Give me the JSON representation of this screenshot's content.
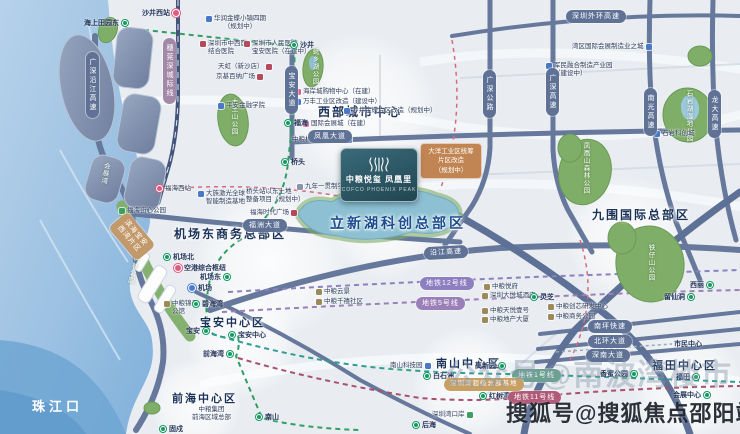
{
  "colors": {
    "sea": "#9cc1e2",
    "land": "#eaedf0",
    "road": "#66789b",
    "park": "#7fae68",
    "lake": "#8cc0d2",
    "reclaimed_block": "#8494b2",
    "metro_green": "#159a62",
    "line12_pill": "#8d7fc0",
    "line5_pill": "#9b7fb8",
    "line1_pill": "#6aa28f",
    "line11_pill": "#b05a78",
    "rail_station": "#e05a80",
    "project_card": "#2e5a68",
    "planning_card": "#c08552",
    "watermark_main": "#22262e"
  },
  "sea": {
    "label": "珠江口"
  },
  "project_card": {
    "title": "中粮悦玺 凤凰里",
    "subtitle": "COFCO PHOENIX PEAK",
    "logo": "cofco-wave-mark"
  },
  "districts": [
    {
      "label": "西部城市中心"
    },
    {
      "label": "机场东商务总部区"
    },
    {
      "label": "立新湖科创总部区"
    },
    {
      "label": "九围国际总部区"
    },
    {
      "label": "宝安中心区"
    },
    {
      "label": "前海中心区"
    },
    {
      "label": "南山中心区"
    },
    {
      "label": "福田中心区"
    }
  ],
  "road_pills": [
    {
      "label": "深圳外环高速"
    },
    {
      "label": "凤凰大道"
    },
    {
      "label": "福洲大道"
    },
    {
      "label": "沿江高速"
    },
    {
      "label": "南坪快速"
    },
    {
      "label": "北环大道"
    },
    {
      "label": "深南大道"
    },
    {
      "label": "广深沿江高速"
    },
    {
      "label": "宝安大道"
    },
    {
      "label": "广深公路"
    },
    {
      "label": "广深高速"
    },
    {
      "label": "南光高速"
    },
    {
      "label": "龙大高速"
    },
    {
      "label": "穗莞深城际线"
    }
  ],
  "metro_pills": [
    {
      "label": "地铁12号线"
    },
    {
      "label": "地铁5号线"
    },
    {
      "label": "地铁1号线"
    },
    {
      "label": "地铁11号线"
    }
  ],
  "zone_pills": [
    {
      "label": "深圳湾超级总部基地"
    },
    {
      "label": "滨海宝安\n西湾片区"
    }
  ],
  "stations": [
    {
      "label": "沙井西站"
    },
    {
      "label": "海上田园东"
    },
    {
      "label": "沙井"
    },
    {
      "label": "福海"
    },
    {
      "label": "桥头"
    },
    {
      "label": "机场北"
    },
    {
      "label": "空港综合枢纽"
    },
    {
      "label": "机场东"
    },
    {
      "label": "机场"
    },
    {
      "label": "碧海湾"
    },
    {
      "label": "宝安"
    },
    {
      "label": "宝安中心"
    },
    {
      "label": "前海湾"
    },
    {
      "label": "南山"
    },
    {
      "label": "固戍"
    },
    {
      "label": "灵芝"
    },
    {
      "label": "后海"
    },
    {
      "label": "红树湾南"
    },
    {
      "label": "白石洲"
    },
    {
      "label": "高新园"
    },
    {
      "label": "西丽"
    },
    {
      "label": "留仙洞"
    },
    {
      "label": "福田"
    },
    {
      "label": "会展中心"
    },
    {
      "label": "市民中心"
    },
    {
      "label": "香蜜公园"
    }
  ],
  "pois": [
    {
      "label": "华润金蝶小镇四期\n（规划中）"
    },
    {
      "label": "深圳市中西医\n结合医院"
    },
    {
      "label": "深圳市人民医院\n宝安医院（在建中）"
    },
    {
      "label": "天虹（新沙店）"
    },
    {
      "label": "京基百纳广场"
    },
    {
      "label": "平安金融学院"
    },
    {
      "label": "海岸城购物中心（在建）"
    },
    {
      "label": "万丰工业区改造（建设中）"
    },
    {
      "label": "沙井金蝶片区改造（规划中）"
    },
    {
      "label": "国际会展城（在建）"
    },
    {
      "label": "湾区国际会展制造业之城"
    },
    {
      "label": "军民融合制造产业园\n（建设中）"
    },
    {
      "label": "石岩科创城"
    },
    {
      "label": "中粮机器人产业园"
    },
    {
      "label": "九年一贯制学校"
    },
    {
      "label": "大洋工业区统筹\n片区改造\n（规划中）"
    },
    {
      "label": "桥头站以东土地\n整备项目（规划中）"
    },
    {
      "label": "大族激光全球\n智能制造基地"
    },
    {
      "label": "福海时代广场"
    },
    {
      "label": "福海西站"
    },
    {
      "label": "福海街心公园"
    },
    {
      "label": "中粮锦云\n公馆"
    },
    {
      "label": "中粮云景"
    },
    {
      "label": "中粮千禧社区"
    },
    {
      "label": "中粮集团\n前海区域总部"
    },
    {
      "label": "中粮悦府"
    },
    {
      "label": "深圳大悦城酒店"
    },
    {
      "label": "中粮天悦壹号"
    },
    {
      "label": "中粮地产大厦"
    },
    {
      "label": "中粮创芯研发中心"
    },
    {
      "label": "中粮商务公园"
    },
    {
      "label": "南山科技园"
    },
    {
      "label": "深圳湾口岸"
    }
  ],
  "parks": [
    {
      "label": "大王山公园"
    },
    {
      "label": "蚝乡湖公园"
    },
    {
      "label": "凤凰山森林公园"
    },
    {
      "label": "石岩湖湿地公园"
    },
    {
      "label": "铁仔山公园"
    },
    {
      "label": "西湾红树林公园"
    },
    {
      "label": "会展湾"
    }
  ],
  "watermarks": {
    "faded": "公众号@南波湾楼市",
    "main": "搜狐号@搜狐焦点邵阳站"
  }
}
